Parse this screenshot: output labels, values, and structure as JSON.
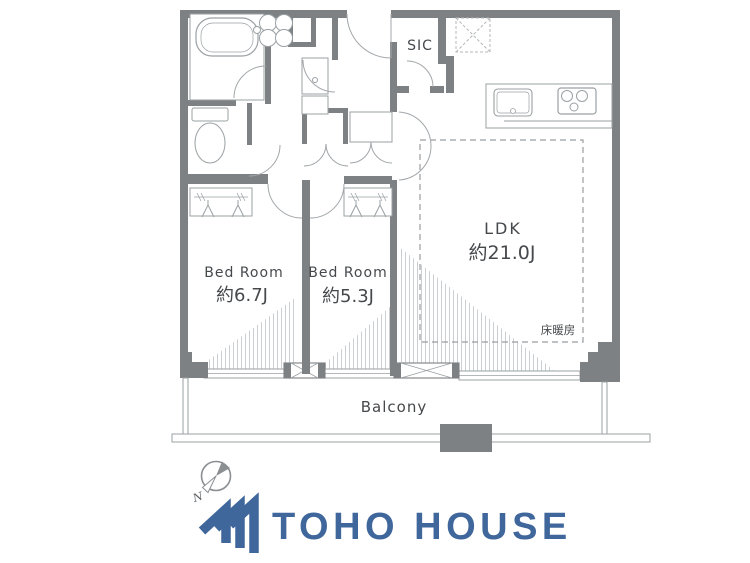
{
  "labels": {
    "sic": "SIC",
    "ldk_name": "LDK",
    "ldk_size": "約21.0J",
    "floor_heating": "床暖房",
    "bedroom1_name": "Bed Room",
    "bedroom1_size": "約6.7J",
    "bedroom2_name": "Bed Room",
    "bedroom2_size": "約5.3J",
    "balcony": "Balcony"
  },
  "compass": {
    "north": "N"
  },
  "logo": {
    "name": "TOHO HOUSE"
  },
  "colors": {
    "wall": "#7d8184",
    "thin_line": "#9aa0a3",
    "hatch": "#cbcfd2",
    "dashed": "#999da0",
    "label_text": "#46494c",
    "logo_blue": "#40679c",
    "compass_gray": "#8b8f92"
  }
}
